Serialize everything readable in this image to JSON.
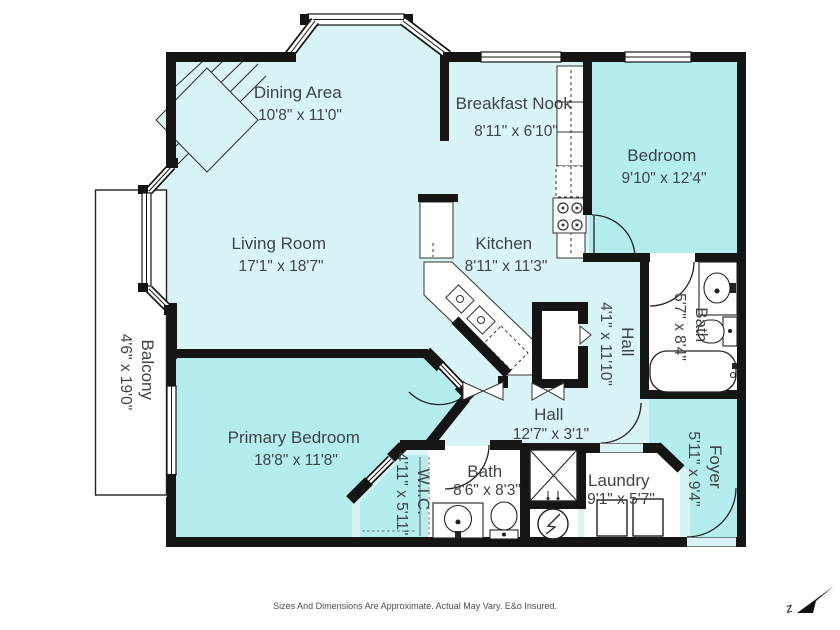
{
  "plan": {
    "rooms": {
      "dining": {
        "name": "Dining Area",
        "dims": "10'8\" x 11'0\""
      },
      "breakfast_nook": {
        "name": "Breakfast Nook",
        "dims": "8'11\" x 6'10\""
      },
      "bedroom": {
        "name": "Bedroom",
        "dims": "9'10\" x 12'4\""
      },
      "living": {
        "name": "Living Room",
        "dims": "17'1\" x 18'7\""
      },
      "kitchen": {
        "name": "Kitchen",
        "dims": "8'11\" x 11'3\""
      },
      "bath_upper": {
        "name": "Bath",
        "dims": "5'7\" x 8'4\""
      },
      "hall_upper": {
        "name": "Hall",
        "dims": "4'1\" x 11'10\""
      },
      "hall_lower": {
        "name": "Hall",
        "dims": "12'7\" x 3'1\""
      },
      "primary": {
        "name": "Primary Bedroom",
        "dims": "18'8\" x 11'8\""
      },
      "wic": {
        "name": "W.I.C.",
        "dims": "4'11\" x 5'11\""
      },
      "bath_lower": {
        "name": "Bath",
        "dims": "8'6\" x 8'3\""
      },
      "laundry": {
        "name": "Laundry",
        "dims": "9'1\" x 5'7\""
      },
      "foyer": {
        "name": "Foyer",
        "dims": "5'11\" x 9'4\""
      },
      "balcony": {
        "name": "Balcony",
        "dims": "4'6\" x 19'0\""
      }
    },
    "disclaimer": "Sizes And Dimensions Are Approximate. Actual May Vary. E&o Insured.",
    "compass_label": "z",
    "colors": {
      "room_light": "#d8f4f5",
      "room_accent": "#b5ecee",
      "wall": "#151515",
      "label": "#3d4449"
    }
  }
}
